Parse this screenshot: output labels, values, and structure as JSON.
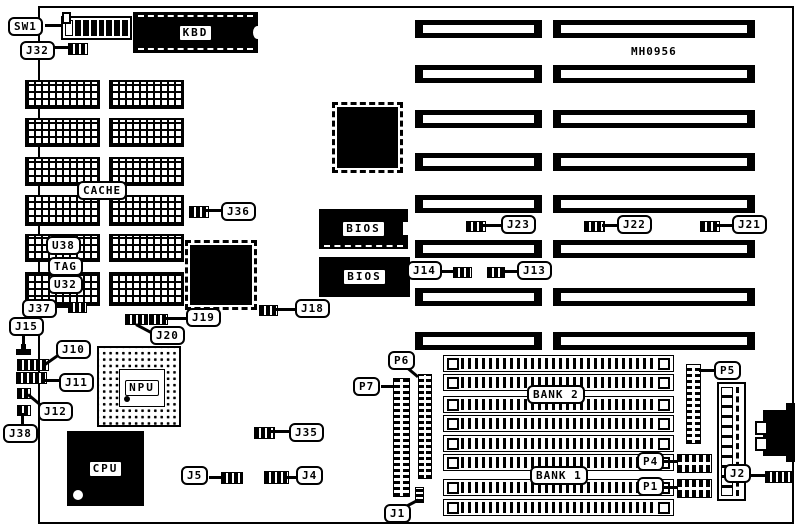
{
  "diagram": {
    "part_number": "MH0956",
    "labels": {
      "sw1": "SW1",
      "j32": "J32",
      "kbd": "KBD",
      "cache": "CACHE",
      "u38": "U38",
      "tag": "TAG",
      "u32": "U32",
      "j37": "J37",
      "j15": "J15",
      "j10": "J10",
      "j11": "J11",
      "j12": "J12",
      "j38": "J38",
      "npu": "NPU",
      "cpu": "CPU",
      "j36": "J36",
      "j19": "J19",
      "j20": "J20",
      "j18": "J18",
      "j35": "J35",
      "j5": "J5",
      "j4": "J4",
      "j1": "J1",
      "p7": "P7",
      "p6": "P6",
      "p5": "P5",
      "p4": "P4",
      "p1": "P1",
      "j2": "J2",
      "bank1": "BANK 1",
      "bank2": "BANK 2",
      "bios_top": "BIOS",
      "bios_bottom": "BIOS",
      "j23": "J23",
      "j22": "J22",
      "j21": "J21",
      "j14": "J14",
      "j13": "J13"
    }
  }
}
